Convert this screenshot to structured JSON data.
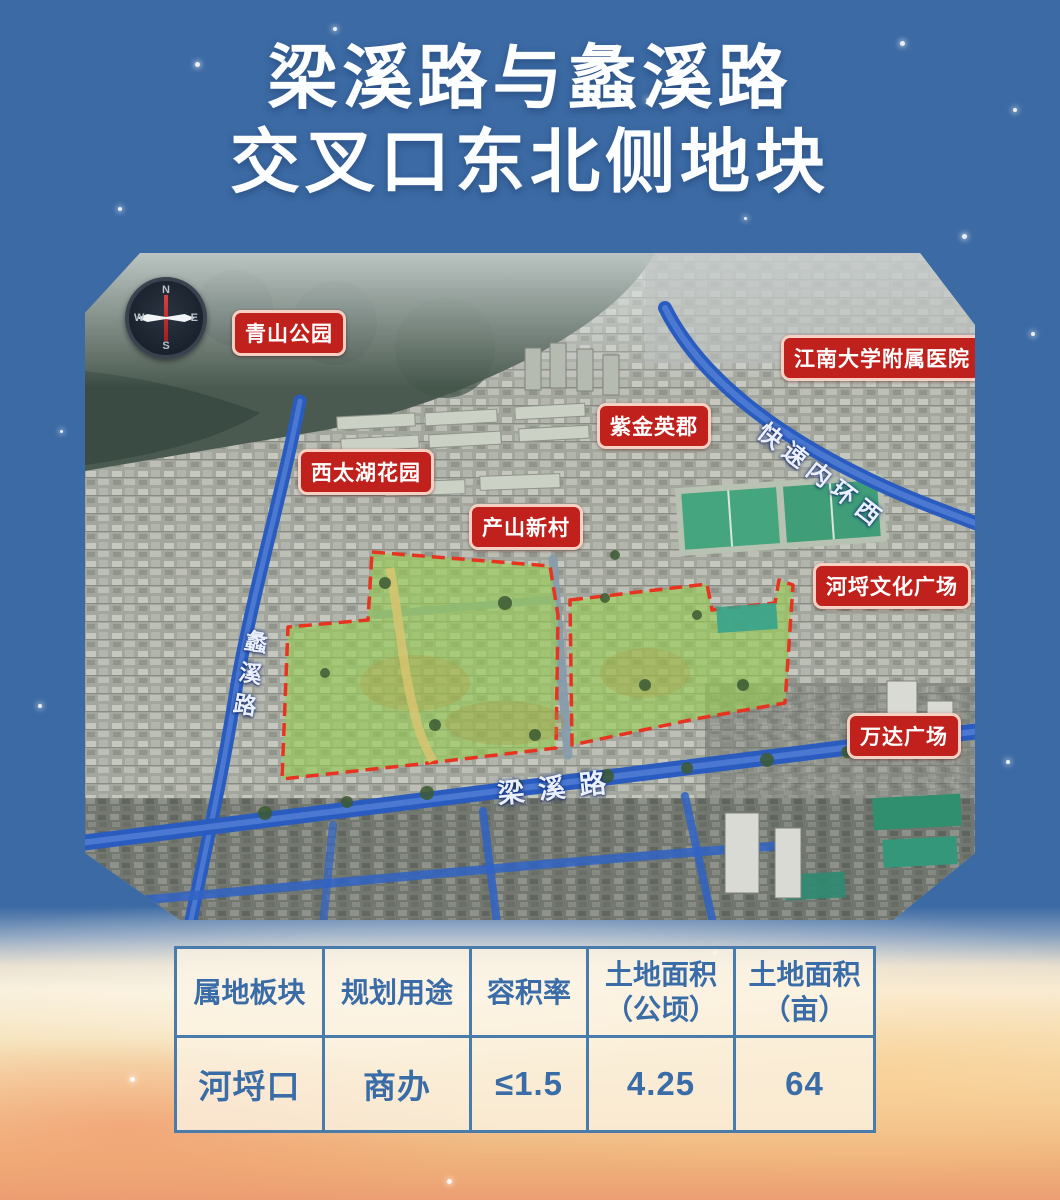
{
  "title": {
    "line1": "梁溪路与蠡溪路",
    "line2": "交叉口东北侧地块"
  },
  "map": {
    "compass": {
      "north": "N",
      "south": "S",
      "east": "E",
      "west": "W"
    },
    "labels": {
      "qingshan_park": "青山公园",
      "xitaihu_garden": "西太湖花园",
      "zijin_yingjun": "紫金英郡",
      "jiangnan_hospital": "江南大学附属医院",
      "chanshan_village": "产山新村",
      "helie_plaza": "河埒文化广场",
      "wanda_plaza": "万达广场"
    },
    "roads": {
      "expressway": "快速内环西",
      "liangxi_road": "梁溪路",
      "lixi_road": "蠡溪路"
    }
  },
  "table": {
    "headers": [
      "属地板块",
      "规划用途",
      "容积率",
      "土地面积\n（公顷）",
      "土地面积\n（亩）"
    ],
    "rows": [
      [
        "河埒口",
        "商办",
        "≤1.5",
        "4.25",
        "64"
      ]
    ]
  },
  "colors": {
    "background_blue": "#3c6aa4",
    "label_red": "#c0211c",
    "road_blue": "#2e63c5",
    "parcel_green": "#8fc84b",
    "parcel_border_red": "#e73421",
    "table_border_blue": "#4a7cab",
    "table_text_blue": "#3a6ca7"
  }
}
